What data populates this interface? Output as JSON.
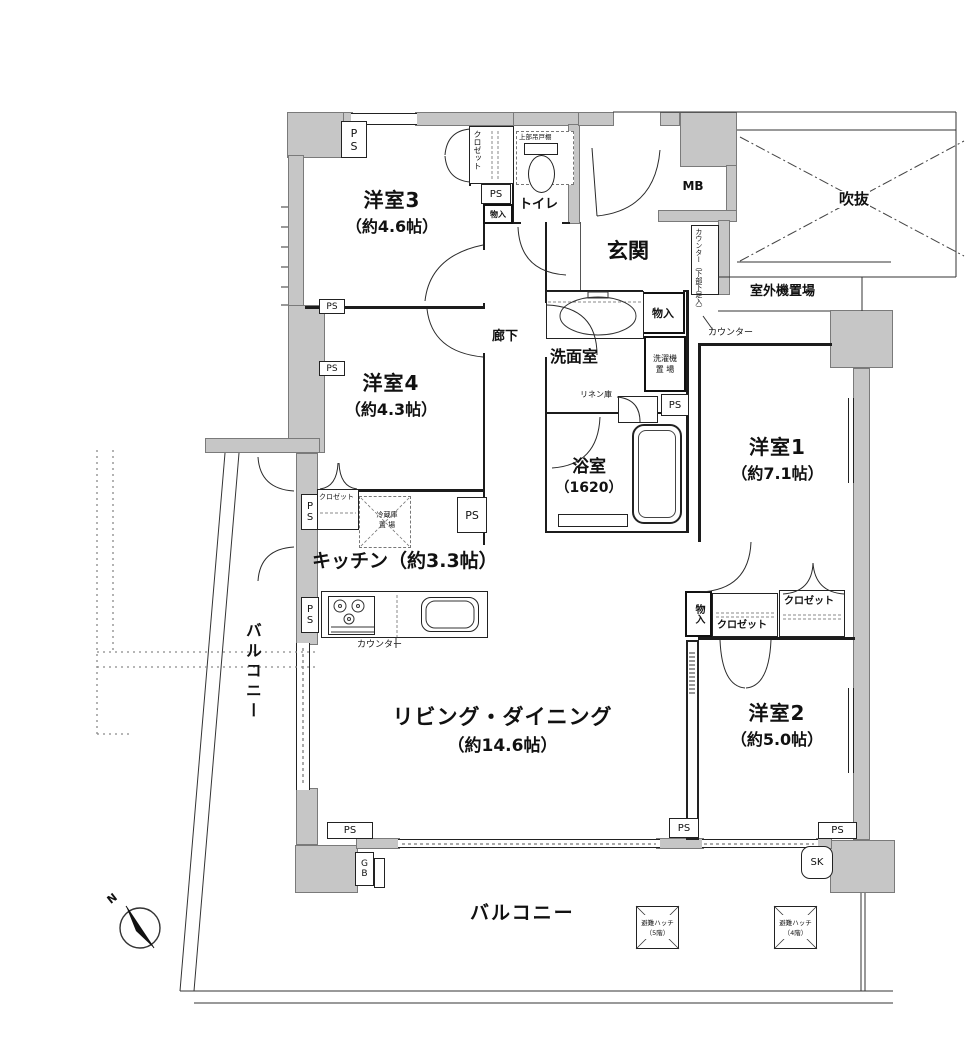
{
  "plan": {
    "rooms": {
      "yoshitsu3": {
        "name": "洋室3",
        "size": "（約4.6帖）"
      },
      "yoshitsu4": {
        "name": "洋室4",
        "size": "（約4.3帖）"
      },
      "yoshitsu1": {
        "name": "洋室1",
        "size": "（約7.1帖）"
      },
      "yoshitsu2": {
        "name": "洋室2",
        "size": "（約5.0帖）"
      },
      "living_dining": {
        "name": "リビング・ダイニング",
        "size": "（約14.6帖）"
      },
      "kitchen": {
        "name": "キッチン（約3.3帖）"
      },
      "bathroom": {
        "name": "浴室",
        "size": "（1620）"
      },
      "washroom": {
        "name": "洗面室"
      },
      "toilet": {
        "name": "トイレ"
      },
      "entrance": {
        "name": "玄関"
      },
      "hallway": {
        "name": "廊下"
      },
      "void_space": {
        "name": "吹抜"
      },
      "balcony_side": {
        "name": "バルコニー"
      },
      "balcony_main": {
        "name": "バルコニー"
      },
      "outdoor_unit": {
        "name": "室外機置場"
      }
    },
    "labels": {
      "ps": "PS",
      "mb": "MB",
      "gb": "GB",
      "sk": "SK",
      "north": "N",
      "closet": "クロゼット",
      "monoire": "物入",
      "upper_cabinet": "上部吊戸棚",
      "counter": "カウンター",
      "counter_shoe": "カウンター（下部下足入）",
      "linen": "リネン庫",
      "laundry_line1": "洗濯機",
      "laundry_line2": "置 場",
      "fridge_line1": "冷蔵庫",
      "fridge_line2": "置 場",
      "hatch": "避難ハッチ",
      "hatch5_floor": "（5階）",
      "hatch4_floor": "（4階）"
    },
    "colors": {
      "wall_fill": "#c6c6c6",
      "line": "#1c1c1c"
    }
  }
}
